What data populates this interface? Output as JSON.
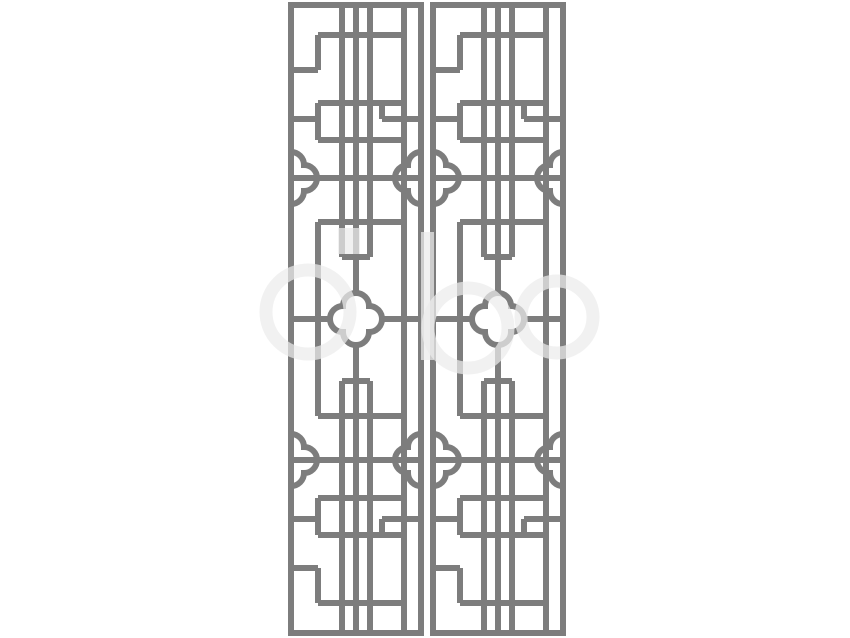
{
  "canvas": {
    "width": 850,
    "height": 638,
    "background_color": "#ffffff"
  },
  "illustration": {
    "kind": "chinese-lattice-window-panel-pair",
    "panel_count": 2,
    "stroke_color": "#7d7d7d",
    "stroke_width": 6,
    "panel_outer_width": 136,
    "panel_outer_height": 634,
    "panels": [
      {
        "id": "left",
        "x": 288,
        "y": 2
      },
      {
        "id": "right",
        "x": 430,
        "y": 2
      }
    ],
    "paths": {
      "frame": "M3,3 H133 V631 H3 Z",
      "grid": "M54,3 V255 M54,379 V631 M68,3 V292 M68,342 V631 M82,3 V255 M82,379 V631 M116,3 V631 M30,33 V68 M30,101 V138 M30,220 V414 M30,496 V533 M30,566 V601 M94,101 V117 M94,517 V533 M30,33 H116 M3,68 H30 M30,101 H116 M3,117 H30 M94,117 H133 M30,138 H116 M3,176 H133 M30,220 H116 M54,255 H82 M3,317 H42 M94,317 H133 M54,379 H82 M30,414 H116 M3,458 H133 M30,496 H116 M3,517 H30 M94,517 H133 M30,533 H116 M3,566 H30 M30,601 H116",
      "quatrefoil": "M55,304 A13,13 0 0 1 81,304 A13,13 0 0 1 81,330 A13,13 0 0 1 55,330 A13,13 0 0 1 55,304 Z",
      "cloud_left_top": "M3,150 A13,13 0 0 1 16,163 A13,13 0 0 1 16,189 A13,13 0 0 1 3,202",
      "cloud_right_top": "M133,150 A13,13 0 0 0 120,163 A13,13 0 0 0 120,189 A13,13 0 0 0 133,202",
      "cloud_left_bottom": "M3,432 A13,13 0 0 1 16,445 A13,13 0 0 1 16,471 A13,13 0 0 1 3,484",
      "cloud_right_bottom": "M133,432 A13,13 0 0 0 120,445 A13,13 0 0 0 120,471 A13,13 0 0 0 133,484"
    }
  },
  "watermark": {
    "color": "#ececec",
    "opacity": 0.72,
    "shapes": [
      {
        "type": "ring",
        "cx": 308,
        "cy": 312,
        "r": 42,
        "stroke_width": 13
      },
      {
        "type": "ring",
        "cx": 468,
        "cy": 328,
        "r": 40,
        "stroke_width": 13
      },
      {
        "type": "ring",
        "cx": 557,
        "cy": 317,
        "r": 36,
        "stroke_width": 13
      },
      {
        "type": "rect",
        "x": 421,
        "y": 232,
        "w": 13,
        "h": 128
      },
      {
        "type": "rect",
        "x": 338,
        "y": 228,
        "w": 22,
        "h": 26
      }
    ]
  }
}
